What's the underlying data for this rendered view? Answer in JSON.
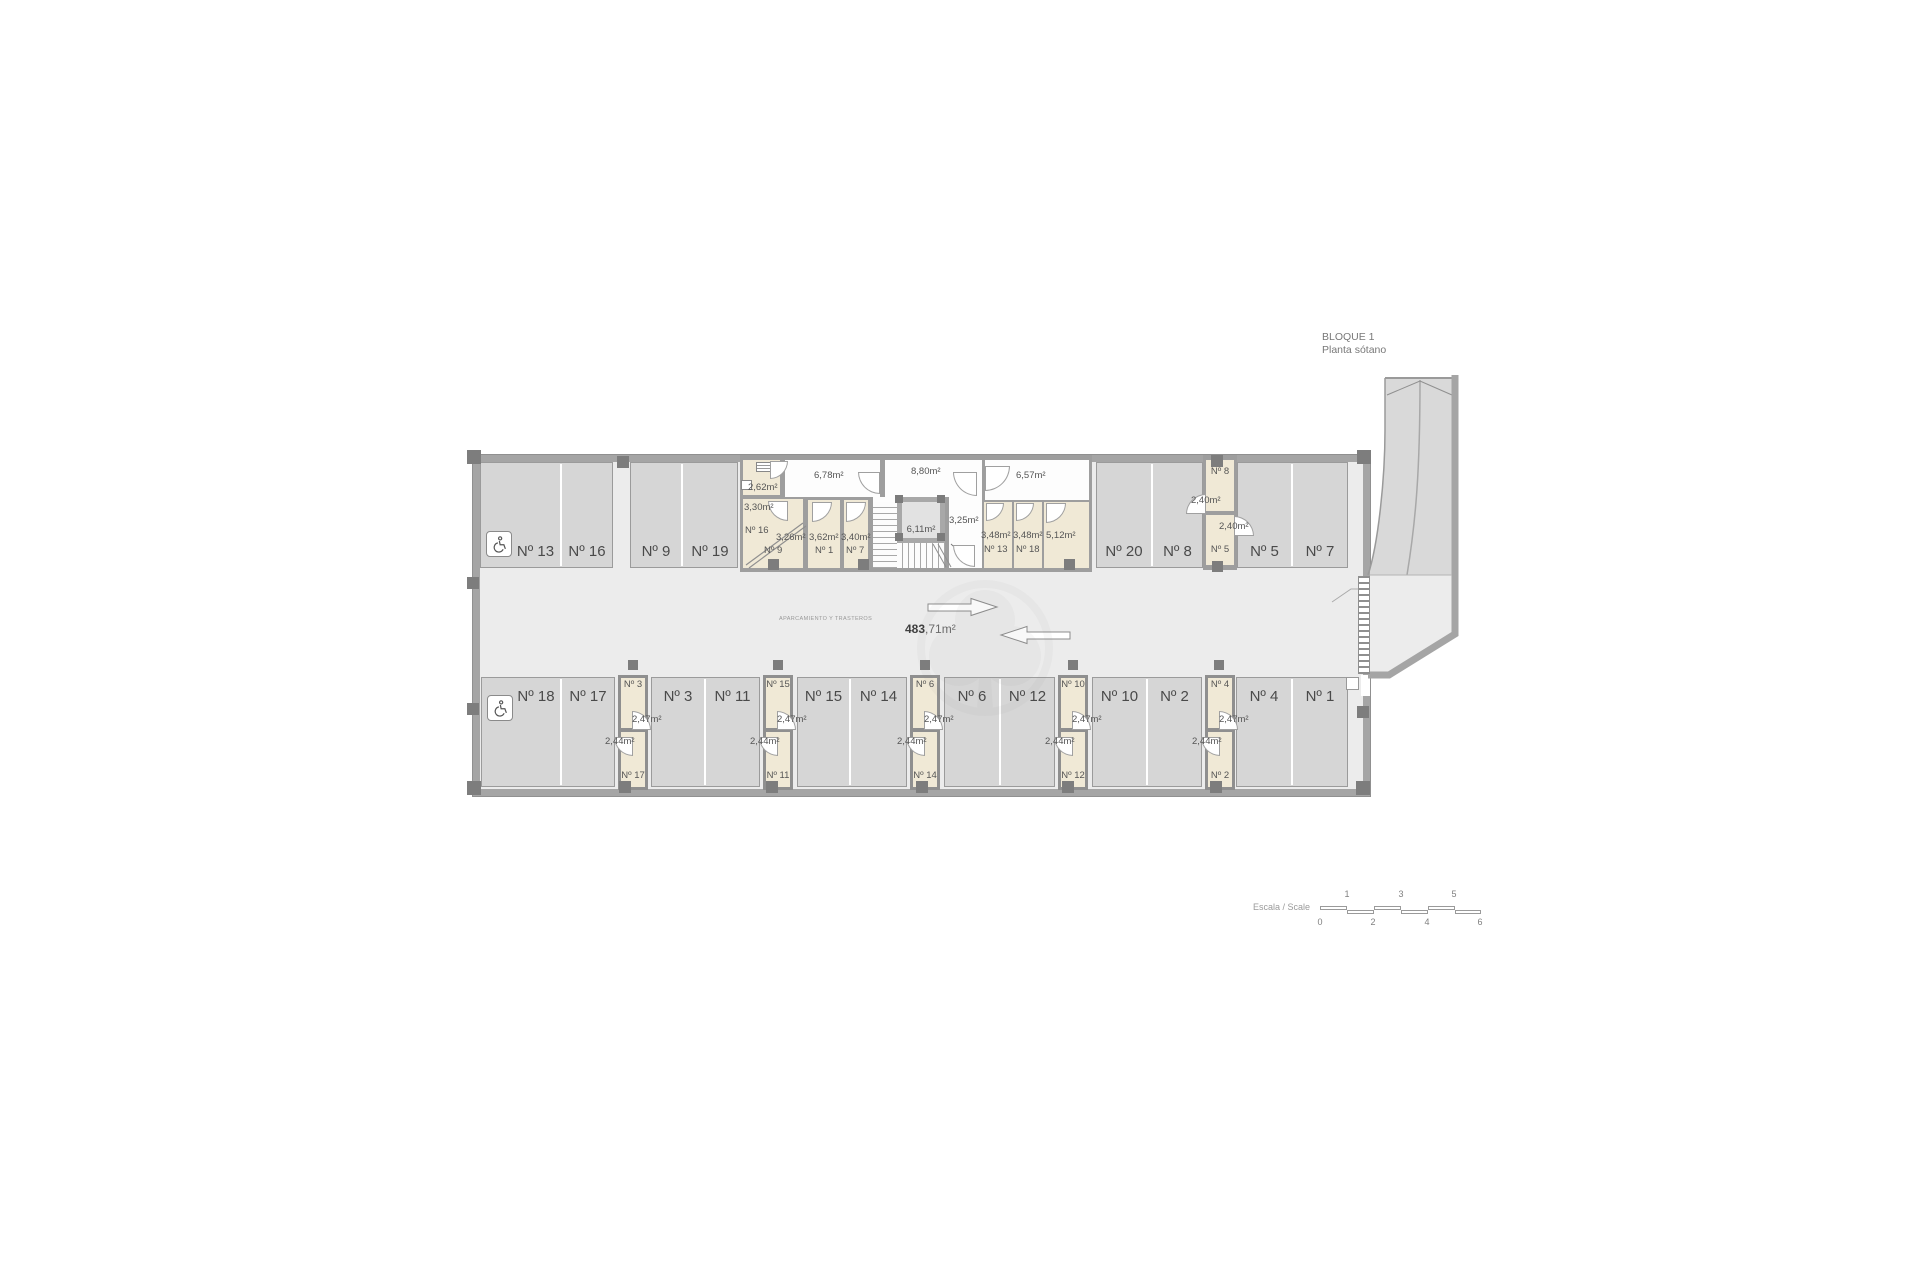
{
  "title": {
    "block": "BLOQUE 1",
    "floor": "Planta sótano"
  },
  "legend": {
    "zone": "APARCAMIENTO Y TRASTEROS",
    "area_int": "483",
    "area_frac": ",71m²"
  },
  "scale": {
    "label": "Escala / Scale",
    "ticks_above": [
      "1",
      "3",
      "5"
    ],
    "ticks_below": [
      "0",
      "2",
      "4",
      "6"
    ]
  },
  "parking": {
    "top_stalls": [
      "Nº 13",
      "Nº 16",
      "Nº 9",
      "Nº 19",
      "Nº 20",
      "Nº 8",
      "Nº 5",
      "Nº 7"
    ],
    "bottom_stalls": [
      "Nº 18",
      "Nº 17",
      "Nº 3",
      "Nº 11",
      "Nº 15",
      "Nº 14",
      "Nº 6",
      "Nº 12",
      "Nº 10",
      "Nº 2",
      "Nº 4",
      "Nº 1"
    ]
  },
  "storerooms": {
    "top_block": {
      "room_262": "2,62m²",
      "room_330": "3,30m²",
      "room_330_no": "Nº 16",
      "room_326": "3,26m²",
      "room_326_no": "Nº 9",
      "corridor_678": "6,78m²",
      "room_362": "3,62m²",
      "room_362_no": "Nº 1",
      "room_340": "3,40m²",
      "room_340_no": "Nº 7",
      "corridor_880": "8,80m²",
      "elevator": "6,11m²",
      "lobby": "3,25m²",
      "corridor_657": "6,57m²",
      "room_348a": "3,48m²",
      "room_348a_no": "Nº 13",
      "room_348b": "3,48m²",
      "room_348b_no": "Nº 18",
      "room_512": "5,12m²"
    },
    "right_column": {
      "top_no": "Nº 8",
      "top_area": "2,40m²",
      "bottom_area": "2,40m²",
      "bottom_no": "Nº 5"
    },
    "bottom_columns": [
      {
        "top_no": "Nº 3",
        "top_area": "2,47m²",
        "bottom_area": "2,44m²",
        "bottom_no": "Nº 17"
      },
      {
        "top_no": "Nº 15",
        "top_area": "2,47m²",
        "bottom_area": "2,44m²",
        "bottom_no": "Nº 11"
      },
      {
        "top_no": "Nº 6",
        "top_area": "2,47m²",
        "bottom_area": "2,44m²",
        "bottom_no": "Nº 14"
      },
      {
        "top_no": "Nº 10",
        "top_area": "2,47m²",
        "bottom_area": "2,44m²",
        "bottom_no": "Nº 12"
      },
      {
        "top_no": "Nº 4",
        "top_area": "2,47m²",
        "bottom_area": "2,44m²",
        "bottom_no": "Nº 2"
      }
    ]
  },
  "colors": {
    "wall": "#a5a5a5",
    "aisle": "#ececec",
    "stall": "#d6d6d6",
    "storeroom": "#f0e9d6",
    "text": "#4a4a4a"
  }
}
